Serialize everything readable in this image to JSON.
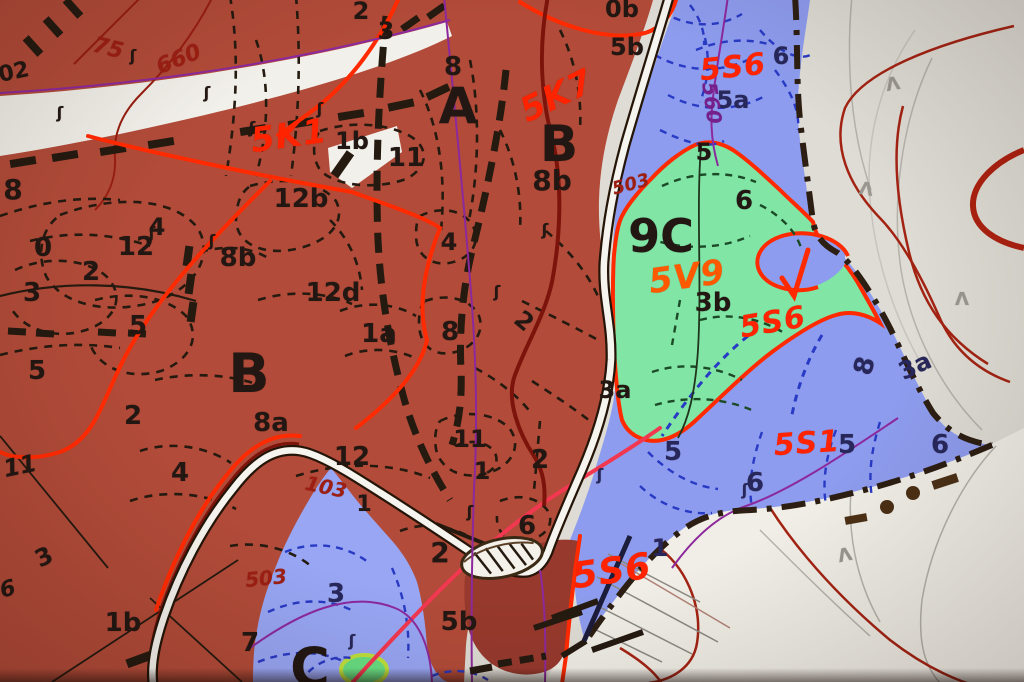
{
  "palette": {
    "forest_red": "#b04c3a",
    "forest_red_dark": "#953a2e",
    "stand_blue": "#8e9cec",
    "stand_blue_light": "#98a6f2",
    "stand_green": "#82e4a6",
    "background_cream": "#dedcd4",
    "background_cream_light": "#f0eee6",
    "road_white": "#f6f4ee",
    "red": "#ff2400",
    "orange": "#ff5a00",
    "pink_red": "#ee3850",
    "darkred": "#9a2014",
    "purple": "#73208a",
    "navy": "#27275a",
    "black": "#221712",
    "gray": "#9a978e",
    "boundary_dark": "#2c1e12"
  },
  "map_labels": [
    {
      "t": "02",
      "x": 14,
      "y": 73,
      "s": 22,
      "r": -12
    },
    {
      "t": "8",
      "x": 13,
      "y": 190,
      "s": 28
    },
    {
      "t": "0",
      "x": 43,
      "y": 248,
      "s": 26
    },
    {
      "t": "12",
      "x": 136,
      "y": 247,
      "s": 26
    },
    {
      "t": "4",
      "x": 157,
      "y": 227,
      "s": 24
    },
    {
      "t": "2",
      "x": 91,
      "y": 272,
      "s": 26
    },
    {
      "t": "3",
      "x": 32,
      "y": 293,
      "s": 26
    },
    {
      "t": "5",
      "x": 138,
      "y": 326,
      "s": 26
    },
    {
      "t": "5",
      "x": 37,
      "y": 371,
      "s": 26
    },
    {
      "t": "2",
      "x": 133,
      "y": 416,
      "s": 26
    },
    {
      "t": "B",
      "x": 249,
      "y": 374,
      "s": 54
    },
    {
      "t": "8a",
      "x": 271,
      "y": 423,
      "s": 26
    },
    {
      "t": "8b",
      "x": 238,
      "y": 258,
      "s": 26
    },
    {
      "t": "12b",
      "x": 301,
      "y": 199,
      "s": 26
    },
    {
      "t": "12d",
      "x": 333,
      "y": 293,
      "s": 26
    },
    {
      "t": "1a",
      "x": 379,
      "y": 334,
      "s": 26
    },
    {
      "t": "8",
      "x": 450,
      "y": 332,
      "s": 26
    },
    {
      "t": "2",
      "x": 524,
      "y": 321,
      "s": 24,
      "r": 40
    },
    {
      "t": "4",
      "x": 449,
      "y": 242,
      "s": 24
    },
    {
      "t": "2",
      "x": 361,
      "y": 11,
      "s": 24
    },
    {
      "t": "3",
      "x": 386,
      "y": 31,
      "s": 24
    },
    {
      "t": "8",
      "x": 453,
      "y": 67,
      "s": 26
    },
    {
      "t": "A",
      "x": 458,
      "y": 106,
      "s": 50
    },
    {
      "t": "B",
      "x": 559,
      "y": 144,
      "s": 50
    },
    {
      "t": "1b",
      "x": 352,
      "y": 141,
      "s": 24
    },
    {
      "t": "11",
      "x": 406,
      "y": 158,
      "s": 26
    },
    {
      "t": "8b",
      "x": 552,
      "y": 181,
      "s": 28
    },
    {
      "t": "0b",
      "x": 622,
      "y": 9,
      "s": 24
    },
    {
      "t": "5b",
      "x": 627,
      "y": 47,
      "s": 24
    },
    {
      "t": "3a",
      "x": 615,
      "y": 390,
      "s": 24
    },
    {
      "t": "12",
      "x": 352,
      "y": 457,
      "s": 26
    },
    {
      "t": "11",
      "x": 470,
      "y": 439,
      "s": 24
    },
    {
      "t": "1",
      "x": 482,
      "y": 471,
      "s": 24
    },
    {
      "t": "2",
      "x": 540,
      "y": 460,
      "s": 26
    },
    {
      "t": "6",
      "x": 527,
      "y": 526,
      "s": 26
    },
    {
      "t": "2",
      "x": 440,
      "y": 553,
      "s": 28
    },
    {
      "t": "5b",
      "x": 459,
      "y": 622,
      "s": 26
    },
    {
      "t": "1",
      "x": 364,
      "y": 505,
      "s": 22
    },
    {
      "t": "11",
      "x": 20,
      "y": 466,
      "s": 24,
      "r": -12,
      "i": true
    },
    {
      "t": "4",
      "x": 180,
      "y": 473,
      "s": 26
    },
    {
      "t": "3",
      "x": 44,
      "y": 557,
      "s": 24,
      "r": -25
    },
    {
      "t": "6",
      "x": 8,
      "y": 590,
      "s": 22,
      "r": -15,
      "i": true
    },
    {
      "t": "1b",
      "x": 123,
      "y": 623,
      "s": 26
    },
    {
      "t": "7",
      "x": 250,
      "y": 643,
      "s": 26
    },
    {
      "t": "C",
      "x": 310,
      "y": 668,
      "s": 54
    },
    {
      "t": "6",
      "x": 781,
      "y": 56,
      "s": 24,
      "c": "navy"
    },
    {
      "t": "5a",
      "x": 733,
      "y": 100,
      "s": 24,
      "c": "navy"
    },
    {
      "t": "3a",
      "x": 915,
      "y": 366,
      "s": 24,
      "c": "navy",
      "r": -25
    },
    {
      "t": "8",
      "x": 865,
      "y": 366,
      "s": 26,
      "c": "navy",
      "r": -75
    },
    {
      "t": "5",
      "x": 673,
      "y": 452,
      "s": 26,
      "c": "navy"
    },
    {
      "t": "6",
      "x": 755,
      "y": 483,
      "s": 26,
      "c": "navy"
    },
    {
      "t": "5",
      "x": 847,
      "y": 445,
      "s": 26,
      "c": "navy"
    },
    {
      "t": "6",
      "x": 940,
      "y": 445,
      "s": 26,
      "c": "navy"
    },
    {
      "t": "1",
      "x": 660,
      "y": 548,
      "s": 24,
      "c": "navy"
    },
    {
      "t": "3",
      "x": 336,
      "y": 594,
      "s": 26,
      "c": "navy"
    },
    {
      "t": "5",
      "x": 704,
      "y": 152,
      "s": 24
    },
    {
      "t": "6",
      "x": 744,
      "y": 201,
      "s": 26
    },
    {
      "t": "9C",
      "x": 661,
      "y": 236,
      "s": 46
    },
    {
      "t": "3b",
      "x": 713,
      "y": 303,
      "s": 26
    },
    {
      "t": "5K1",
      "x": 289,
      "y": 136,
      "s": 34,
      "c": "red",
      "r": -8,
      "i": true
    },
    {
      "t": "5K7",
      "x": 557,
      "y": 96,
      "s": 34,
      "c": "red",
      "r": -26,
      "i": true
    },
    {
      "t": "5S6",
      "x": 733,
      "y": 68,
      "s": 30,
      "c": "red",
      "r": -6,
      "i": true
    },
    {
      "t": "5S6",
      "x": 773,
      "y": 323,
      "s": 30,
      "c": "red",
      "r": -10,
      "i": true
    },
    {
      "t": "5S1",
      "x": 807,
      "y": 444,
      "s": 30,
      "c": "red",
      "r": -4,
      "i": true
    },
    {
      "t": "5S6",
      "x": 612,
      "y": 572,
      "s": 36,
      "c": "red",
      "r": -8,
      "i": true
    },
    {
      "t": "5V9",
      "x": 687,
      "y": 277,
      "s": 34,
      "c": "orange",
      "r": -8,
      "i": true
    },
    {
      "t": "75",
      "x": 108,
      "y": 49,
      "s": 22,
      "c": "darkred",
      "r": 14,
      "i": true
    },
    {
      "t": "660",
      "x": 179,
      "y": 60,
      "s": 22,
      "c": "darkred",
      "r": -22,
      "i": true
    },
    {
      "t": "503",
      "x": 631,
      "y": 185,
      "s": 18,
      "c": "darkred",
      "r": -15,
      "i": true
    },
    {
      "t": "503",
      "x": 266,
      "y": 578,
      "s": 20,
      "c": "darkred",
      "r": -6,
      "i": true
    },
    {
      "t": "103",
      "x": 326,
      "y": 487,
      "s": 20,
      "c": "darkred",
      "r": 12,
      "i": true
    },
    {
      "t": "560",
      "x": 712,
      "y": 103,
      "s": 20,
      "c": "purple",
      "r": 82,
      "i": true
    },
    {
      "t": "ʃ",
      "x": 133,
      "y": 56,
      "s": 16
    },
    {
      "t": "ʃ",
      "x": 207,
      "y": 93,
      "s": 16
    },
    {
      "t": "ʃ",
      "x": 252,
      "y": 128,
      "s": 16
    },
    {
      "t": "ʃ",
      "x": 320,
      "y": 109,
      "s": 16
    },
    {
      "t": "ʃ",
      "x": 60,
      "y": 113,
      "s": 16
    },
    {
      "t": "ʃ",
      "x": 152,
      "y": 233,
      "s": 16
    },
    {
      "t": "ʃ",
      "x": 212,
      "y": 241,
      "s": 16
    },
    {
      "t": "ʃ",
      "x": 545,
      "y": 230,
      "s": 16
    },
    {
      "t": "ʃ",
      "x": 497,
      "y": 292,
      "s": 16
    },
    {
      "t": "ʃ",
      "x": 470,
      "y": 512,
      "s": 16
    },
    {
      "t": "ʃ",
      "x": 745,
      "y": 490,
      "s": 16,
      "c": "navy"
    },
    {
      "t": "ʃ",
      "x": 352,
      "y": 641,
      "s": 16,
      "c": "navy"
    },
    {
      "t": "ʃ",
      "x": 600,
      "y": 475,
      "s": 16,
      "c": "navy"
    },
    {
      "t": "Λ",
      "x": 893,
      "y": 85,
      "s": 18,
      "c": "gray",
      "r": -10
    },
    {
      "t": "Λ",
      "x": 866,
      "y": 190,
      "s": 18,
      "c": "gray",
      "r": 8
    },
    {
      "t": "Λ",
      "x": 962,
      "y": 300,
      "s": 18,
      "c": "gray"
    },
    {
      "t": "Λ",
      "x": 845,
      "y": 556,
      "s": 18,
      "c": "gray",
      "r": -12
    }
  ]
}
